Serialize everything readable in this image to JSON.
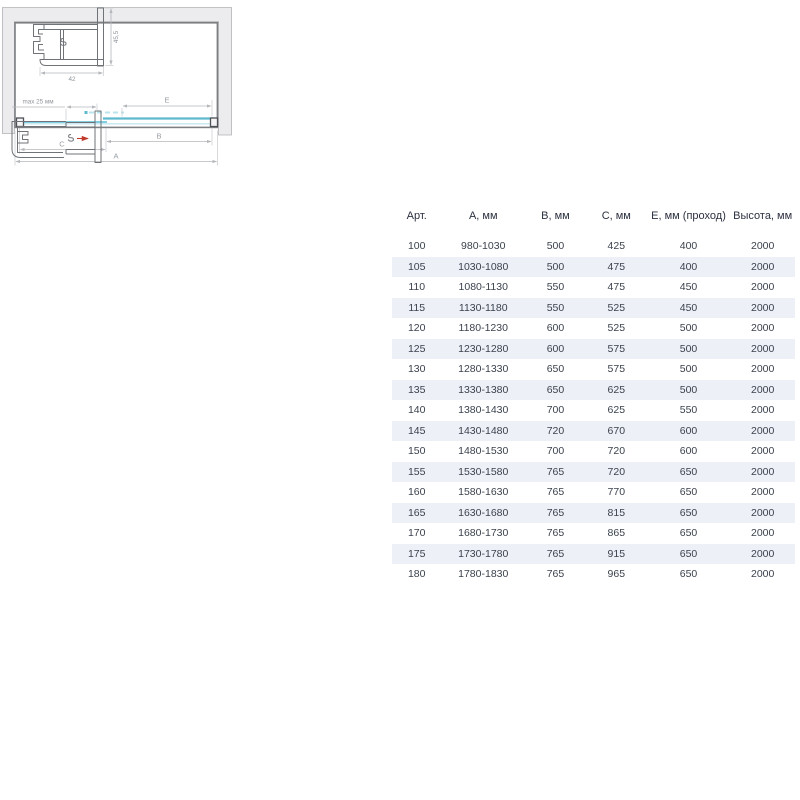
{
  "diagram": {
    "dim_labels": {
      "a": "A",
      "b": "B",
      "c": "C",
      "e": "E"
    },
    "profile_top": {
      "width_label": "42",
      "height_label": "45,5"
    },
    "profile_bottom": {
      "adjustment_label": "max 25 мм"
    },
    "colors": {
      "glass_door": "#5fb9cf",
      "glass_fixed": "#82cde0",
      "glass_track": "#c3e7f0",
      "glass_dashed": "#b8e4ee",
      "wall_fill": "#ececee",
      "frame_line": "#7d8083",
      "arrow_red": "#c0392b",
      "stripe": "#eef0f7"
    }
  },
  "table": {
    "columns": [
      "Арт.",
      "А, мм",
      "В, мм",
      "С, мм",
      "Е, мм (проход)",
      "Высота, мм"
    ],
    "rows": [
      [
        "100",
        "980-1030",
        "500",
        "425",
        "400",
        "2000"
      ],
      [
        "105",
        "1030-1080",
        "500",
        "475",
        "400",
        "2000"
      ],
      [
        "110",
        "1080-1130",
        "550",
        "475",
        "450",
        "2000"
      ],
      [
        "115",
        "1130-1180",
        "550",
        "525",
        "450",
        "2000"
      ],
      [
        "120",
        "1180-1230",
        "600",
        "525",
        "500",
        "2000"
      ],
      [
        "125",
        "1230-1280",
        "600",
        "575",
        "500",
        "2000"
      ],
      [
        "130",
        "1280-1330",
        "650",
        "575",
        "500",
        "2000"
      ],
      [
        "135",
        "1330-1380",
        "650",
        "625",
        "500",
        "2000"
      ],
      [
        "140",
        "1380-1430",
        "700",
        "625",
        "550",
        "2000"
      ],
      [
        "145",
        "1430-1480",
        "720",
        "670",
        "600",
        "2000"
      ],
      [
        "150",
        "1480-1530",
        "700",
        "720",
        "600",
        "2000"
      ],
      [
        "155",
        "1530-1580",
        "765",
        "720",
        "650",
        "2000"
      ],
      [
        "160",
        "1580-1630",
        "765",
        "770",
        "650",
        "2000"
      ],
      [
        "165",
        "1630-1680",
        "765",
        "815",
        "650",
        "2000"
      ],
      [
        "170",
        "1680-1730",
        "765",
        "865",
        "650",
        "2000"
      ],
      [
        "175",
        "1730-1780",
        "765",
        "915",
        "650",
        "2000"
      ],
      [
        "180",
        "1780-1830",
        "765",
        "965",
        "650",
        "2000"
      ]
    ]
  }
}
